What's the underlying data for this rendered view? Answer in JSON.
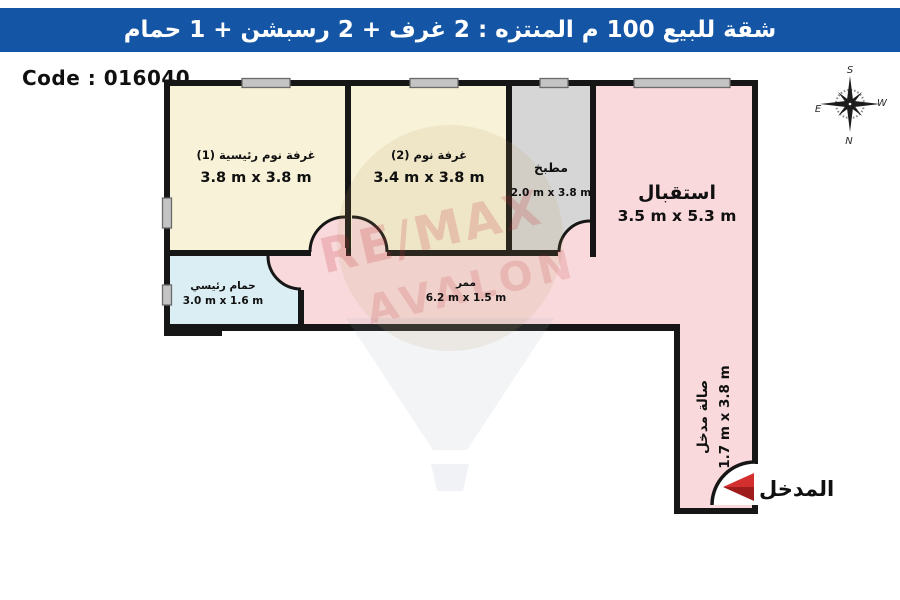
{
  "header": {
    "title": "شقة للبيع 100 م المنتزه : 2 غرف + 2 رسبشن + 1 حمام",
    "bg_color": "#1456a5"
  },
  "code_label": "Code : 016040",
  "compass": {
    "top": "S",
    "bottom": "N",
    "left": "E",
    "right": "W"
  },
  "watermark": {
    "line1": "RE/MAX",
    "line2": "AVALON"
  },
  "rooms": {
    "master_bedroom": {
      "name": "غرفة نوم رئيسية (1)",
      "dims": "3.8 m x 3.8 m",
      "color": "#f7f2d8"
    },
    "bedroom2": {
      "name": "غرفة نوم (2)",
      "dims": "3.4 m x 3.8 m",
      "color": "#f7f2d8"
    },
    "kitchen": {
      "name": "مطبخ",
      "dims": "2.0 m x 3.8 m",
      "color": "#d6d6d6"
    },
    "reception": {
      "name": "استقبال",
      "dims": "3.5 m x 5.3 m",
      "color": "#f9d9dc"
    },
    "bathroom": {
      "name": "حمام رئيسي",
      "dims": "3.0 m x 1.6 m",
      "color": "#daeef4"
    },
    "corridor": {
      "name": "ممر",
      "dims": "6.2 m x 1.5 m",
      "color": "#f9d9dc"
    },
    "entrance_hall": {
      "name": "صالة مدخل",
      "dims": "1.7 m x 3.8 m",
      "color": "#f9d9dc"
    }
  },
  "entrance": {
    "label": "المدخل",
    "arrow_color": "#d32f2f",
    "arrow_color_dark": "#9e1c1c"
  },
  "wall_color": "#161616",
  "floor_base_color": "#f9d9dc"
}
